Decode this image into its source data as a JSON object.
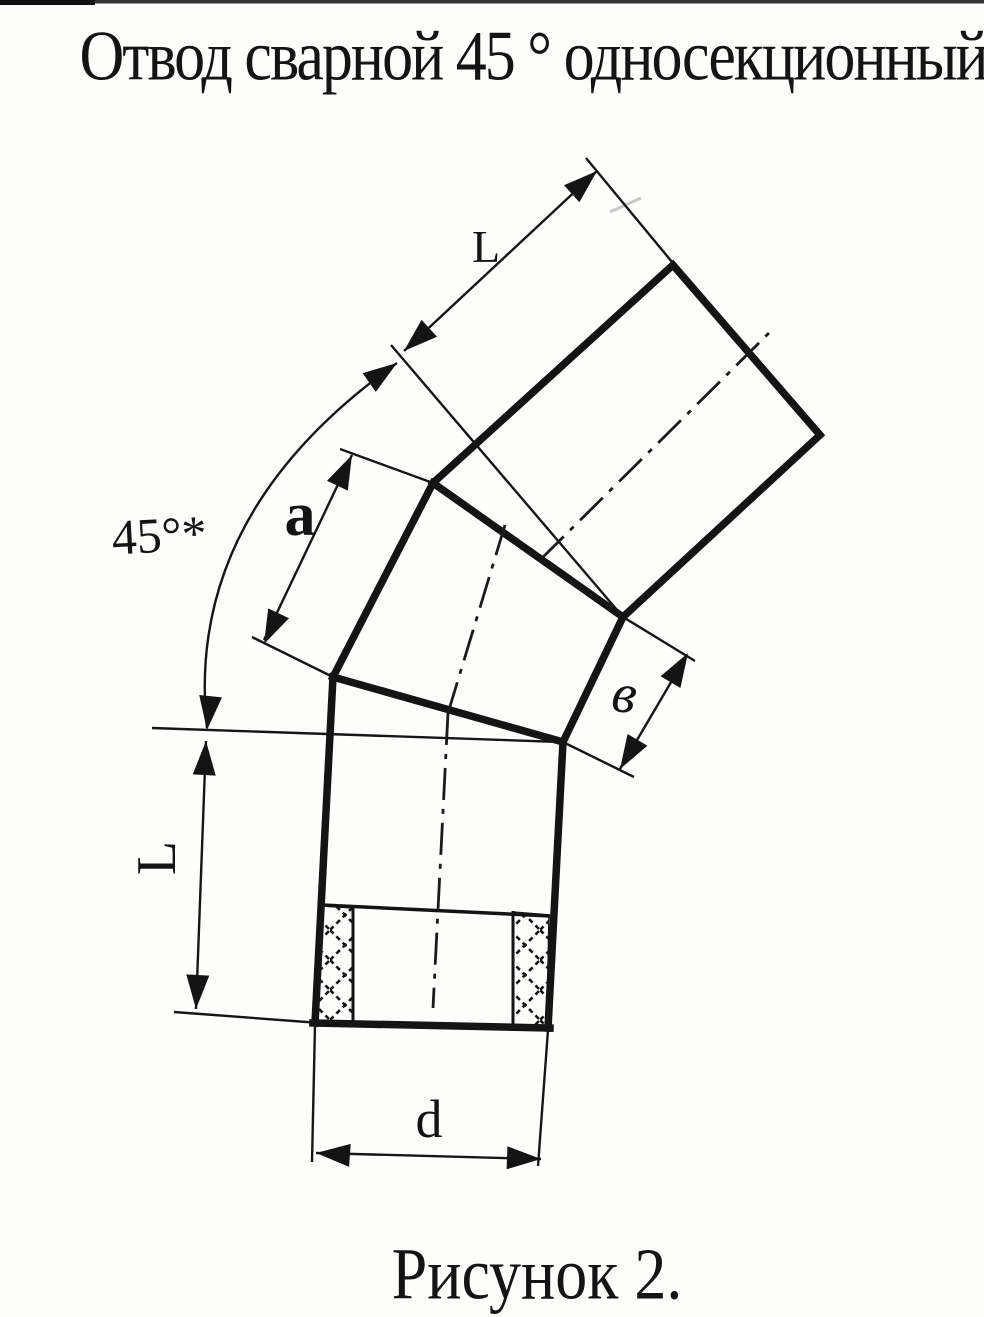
{
  "page": {
    "paper_color": "#fdfdfc",
    "ink_color": "#141414"
  },
  "title": "Отвод сварной 45 ° односекционный",
  "caption": "Рисунок 2.",
  "dimension_labels": {
    "upper_section_length": "L",
    "lower_section_length": "L",
    "middle_section_long_side": "a",
    "middle_section_short_side": "в",
    "bend_angle": "45°*",
    "pipe_diameter": "d"
  }
}
